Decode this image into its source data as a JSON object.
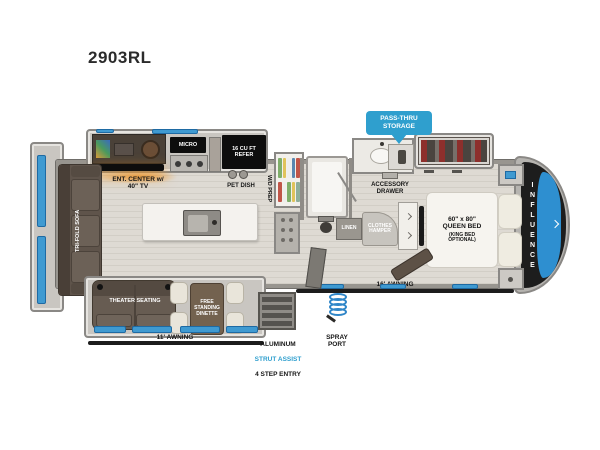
{
  "page": {
    "model": "2903RL"
  },
  "floorplan": {
    "brand": "INFLUENCE",
    "callouts": {
      "pass_thru_storage": "PASS-THRU\nSTORAGE"
    },
    "kitchen": {
      "micro": "MICRO",
      "refer": "16 CU FT\nREFER",
      "ent_center": "ENT. CENTER w/\n40\" TV",
      "pet_dish": "PET DISH",
      "wd_prep": "W/D PREP"
    },
    "bath": {
      "accessory_drawer": "ACCESSORY\nDRAWER",
      "linen": "LINEN",
      "clothes_hamper": "CLOTHES\nHAMPER"
    },
    "living": {
      "tri_fold_sofa": "TRI-FOLD SOFA",
      "theater_seating": "THEATER SEATING",
      "dinette": "FREE\nSTANDING\nDINETTE"
    },
    "bedroom": {
      "bed_size": "60\" x 80\"\nQUEEN BED",
      "bed_option": "(KING BED\nOPTIONAL)"
    },
    "exterior": {
      "awning_left": "11' AWNING",
      "awning_right": "16' AWNING",
      "entry_material": "ALUMINUM",
      "entry_feature": "STRUT ASSIST",
      "entry_steps": "4 STEP ENTRY",
      "spray_port": "SPRAY\nPORT"
    }
  },
  "icons": {
    "pass_thru_pointer": "triangle-down",
    "spray_port": "coiled-hose",
    "pet_dish": "two-bowls",
    "stove": "three-burner-range",
    "island_sink": "basin-with-faucet",
    "front_cap_arrow": "chevron-right",
    "wardrobe_chevrons": "chevron-right"
  },
  "colors": {
    "callout_blue": "#2f9fce",
    "strut_assist_text": "#2f9fce",
    "window_blue": "#3f9ad1",
    "appliance_black": "#0d0d0d",
    "front_cap_black": "#1d1d1d",
    "front_window_blue": "#2e8fd0",
    "floor_wood": "#d9d5cd",
    "wall_gray": "#8a8885",
    "sofa_brown": "#5f544b",
    "dinette_cream": "#e9e5da",
    "glow_orange": "#f08c14"
  }
}
